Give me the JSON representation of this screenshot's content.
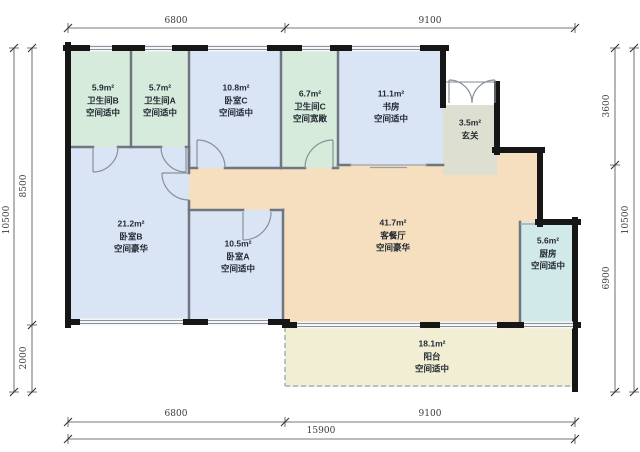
{
  "plan_title": "户型图",
  "colors": {
    "bathroom": "#d7ebdc",
    "bedroom": "#d9e4f5",
    "living": "#f5dfbe",
    "entry": "#dde0d0",
    "kitchen": "#d2e9e9",
    "balcony": "#f1eed4",
    "exterior_wall": "#161616",
    "interior_wall": "#6f7680",
    "dimension_line": "#4a4a4a"
  },
  "rooms": {
    "bathroom_b": {
      "area": "5.9m²",
      "name": "卫生间B",
      "grade": "空间适中"
    },
    "bathroom_a": {
      "area": "5.7m²",
      "name": "卫生间A",
      "grade": "空间适中"
    },
    "bedroom_c": {
      "area": "10.8m²",
      "name": "卧室C",
      "grade": "空间适中"
    },
    "bathroom_c": {
      "area": "6.7m²",
      "name": "卫生间C",
      "grade": "空间宽敞"
    },
    "study": {
      "area": "11.1m²",
      "name": "书房",
      "grade": "空间适中"
    },
    "entry": {
      "area": "3.5m²",
      "name": "玄关"
    },
    "bedroom_b": {
      "area": "21.2m²",
      "name": "卧室B",
      "grade": "空间豪华"
    },
    "bedroom_a": {
      "area": "10.5m²",
      "name": "卧室A",
      "grade": "空间适中"
    },
    "living": {
      "area": "41.7m²",
      "name": "客餐厅",
      "grade": "空间豪华"
    },
    "kitchen": {
      "area": "5.6m²",
      "name": "厨房",
      "grade": "空间适中"
    },
    "balcony": {
      "area": "18.1m²",
      "name": "阳台",
      "grade": "空间适中"
    }
  },
  "dimensions": {
    "top": {
      "left": "6800",
      "right": "9100"
    },
    "bottom": {
      "left": "6800",
      "right": "9100",
      "total": "15900"
    },
    "left": {
      "upper": "8500",
      "lower": "2000",
      "total": "10500"
    },
    "right": {
      "upper": "3600",
      "lower": "6900",
      "total": "10500"
    }
  }
}
